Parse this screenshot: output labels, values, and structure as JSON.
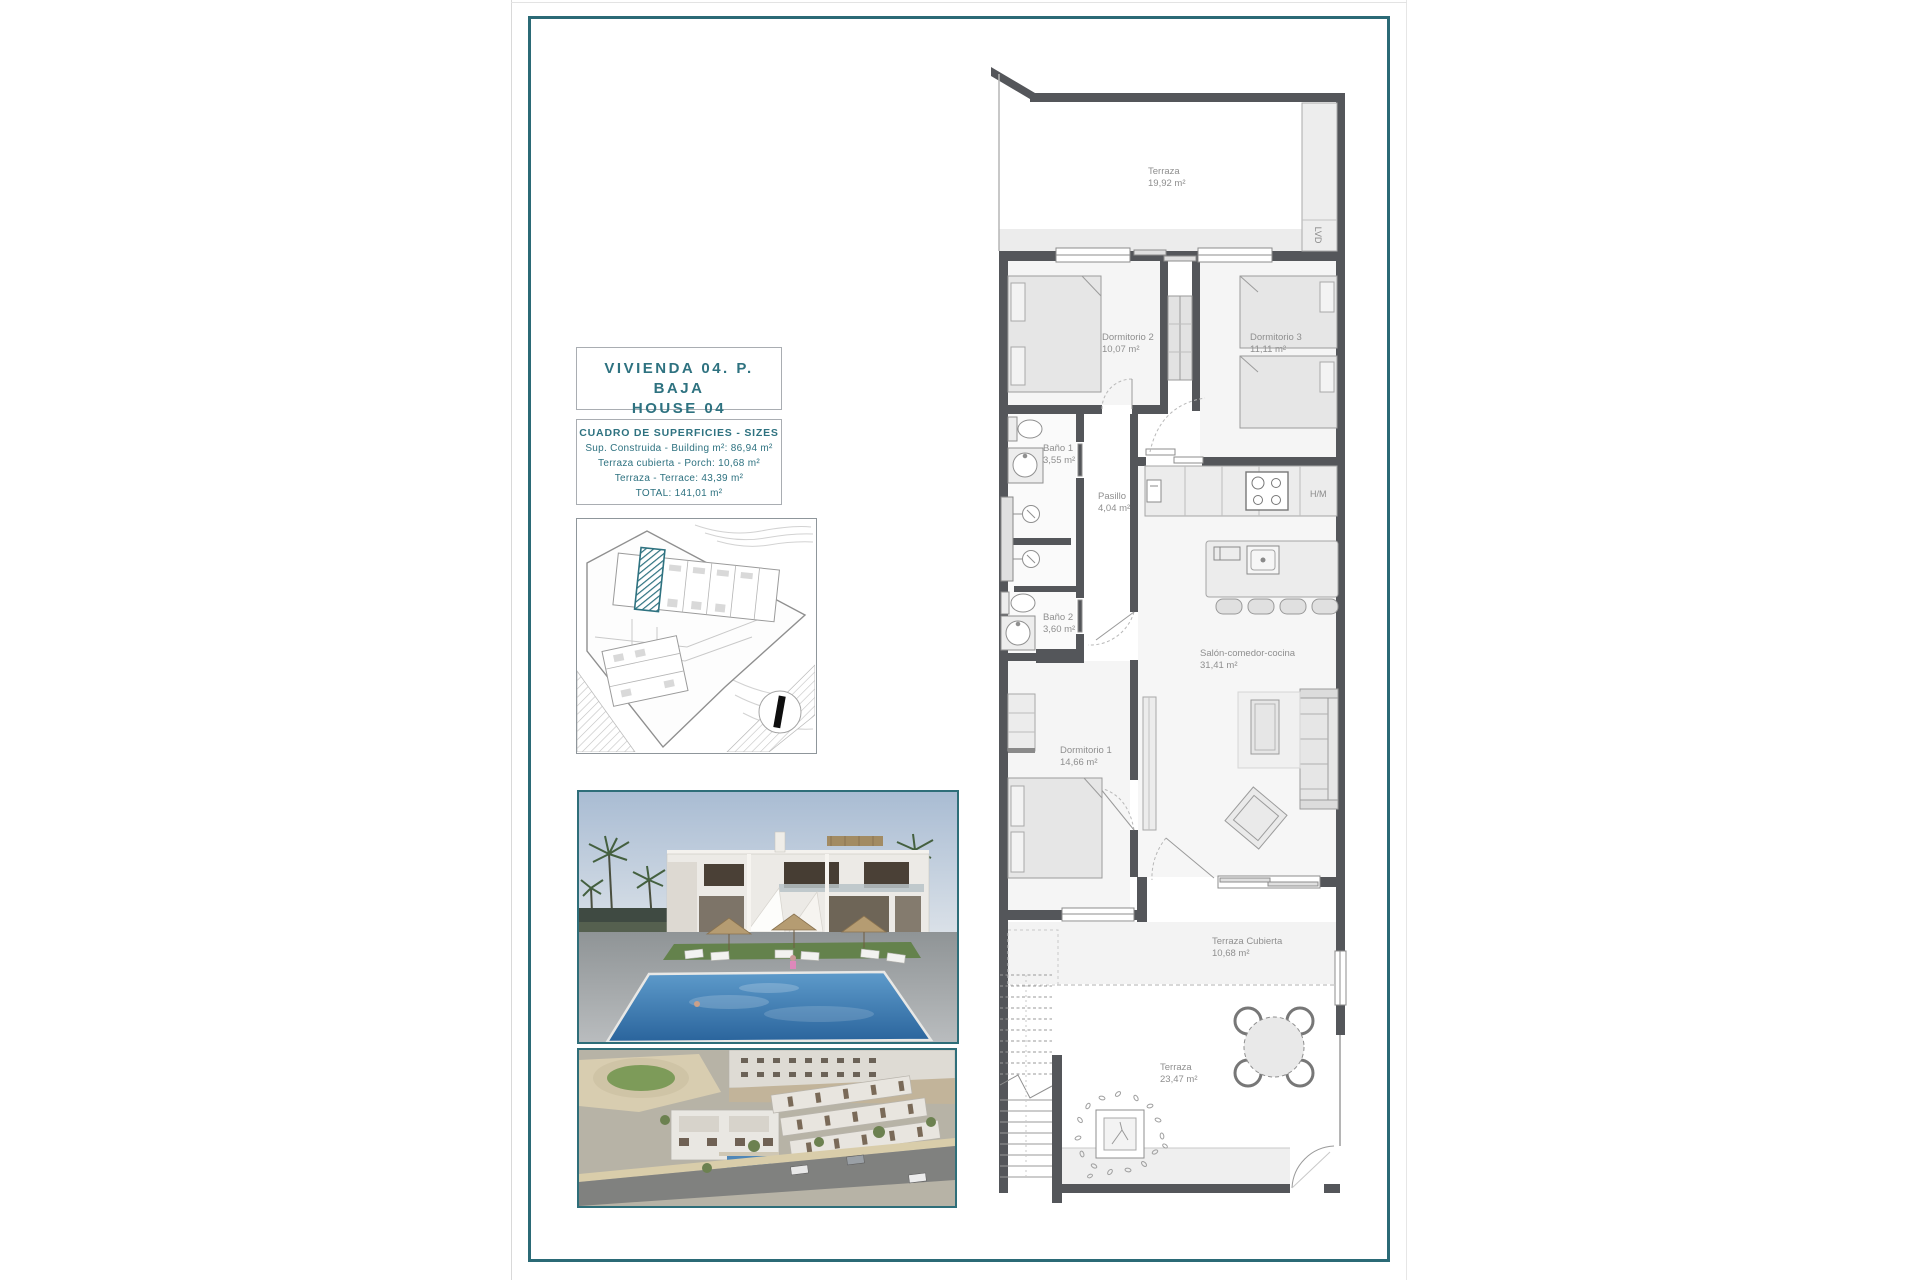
{
  "document": {
    "title_line1": "VIVIENDA 04. P. BAJA",
    "title_line2": "HOUSE 04",
    "sizes_table": {
      "heading": "CUADRO DE SUPERFICIES - SIZES",
      "rows": [
        "Sup. Construida - Building m²: 86,94 m²",
        "Terraza cubierta - Porch: 10,68 m²",
        "Terraza - Terrace: 43,39 m²",
        "TOTAL: 141,01 m²"
      ]
    }
  },
  "floor_plan": {
    "rooms": [
      {
        "id": "terraza-top",
        "name": "Terraza",
        "area": "19,92 m²"
      },
      {
        "id": "dormitorio-2",
        "name": "Dormitorio 2",
        "area": "10,07 m²"
      },
      {
        "id": "dormitorio-3",
        "name": "Dormitorio 3",
        "area": "11,11 m²"
      },
      {
        "id": "bano-1",
        "name": "Baño 1",
        "area": "3,55 m²"
      },
      {
        "id": "pasillo",
        "name": "Pasillo",
        "area": "4,04 m²"
      },
      {
        "id": "bano-2",
        "name": "Baño 2",
        "area": "3,60 m²"
      },
      {
        "id": "salon",
        "name": "Salón-comedor-cocina",
        "area": "31,41 m²"
      },
      {
        "id": "dormitorio-1",
        "name": "Dormitorio 1",
        "area": "14,66 m²"
      },
      {
        "id": "terraza-cubierta",
        "name": "Terraza Cubierta",
        "area": "10,68 m²"
      },
      {
        "id": "terraza-bottom",
        "name": "Terraza",
        "area": "23,47 m²"
      }
    ],
    "annotations": {
      "laundry_column": "LVD",
      "appliance": "H/M"
    }
  },
  "colors": {
    "frame_teal": "#2b6a76",
    "accent_text": "#2e7280",
    "wall_gray": "#54565a",
    "label_gray": "#8f8f8f",
    "site_highlight": "#2e7280",
    "pool_blue": "#2f6ea8"
  }
}
